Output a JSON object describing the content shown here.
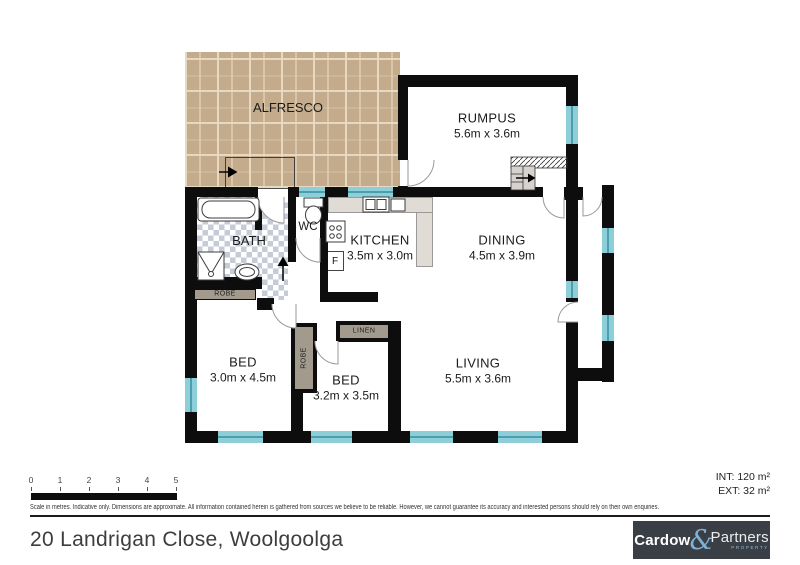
{
  "floorplan": {
    "rooms": {
      "alfresco": {
        "name": "ALFRESCO"
      },
      "rumpus": {
        "name": "RUMPUS",
        "dims": "5.6m x 3.6m"
      },
      "bath": {
        "name": "BATH"
      },
      "wc": {
        "name": "WC"
      },
      "kitchen": {
        "name": "KITCHEN",
        "dims": "3.5m x 3.0m"
      },
      "dining": {
        "name": "DINING",
        "dims": "4.5m x 3.9m"
      },
      "bed1": {
        "name": "BED",
        "dims": "3.0m x 4.5m"
      },
      "bed2": {
        "name": "BED",
        "dims": "3.2m x 3.5m"
      },
      "living": {
        "name": "LIVING",
        "dims": "5.5m x 3.6m"
      }
    },
    "storage": {
      "robe_bath": "ROBE",
      "robe_hall": "ROBE",
      "linen": "LINEN"
    },
    "appliances": {
      "fridge": "F"
    },
    "areas": {
      "int": "INT: 120 m²",
      "ext": "EXT: 32 m²"
    }
  },
  "scale_bar": {
    "ticks": [
      "0",
      "1",
      "2",
      "3",
      "4",
      "5"
    ]
  },
  "disclaimer": "Scale in metres. Indicative only. Dimensions are approximate. All information contained herein is gathered from sources we believe to be reliable. However, we cannot guarantee its accuracy and interested persons should rely on their own enquiries.",
  "address": "20 Landrigan Close, Woolgoolga",
  "brand": {
    "word1": "Cardow",
    "ampersand": "&",
    "word2": "Partners",
    "tagline": "PROPERTY"
  },
  "colors": {
    "wall": "#0d0d0d",
    "window": "#8ccfd9",
    "paver": "#c4ab8b",
    "tile": "#c6ccd7",
    "joinery": "#a29a8d",
    "accent_blue": "#7fb0d6",
    "logo_bg": "#3a3e45"
  }
}
